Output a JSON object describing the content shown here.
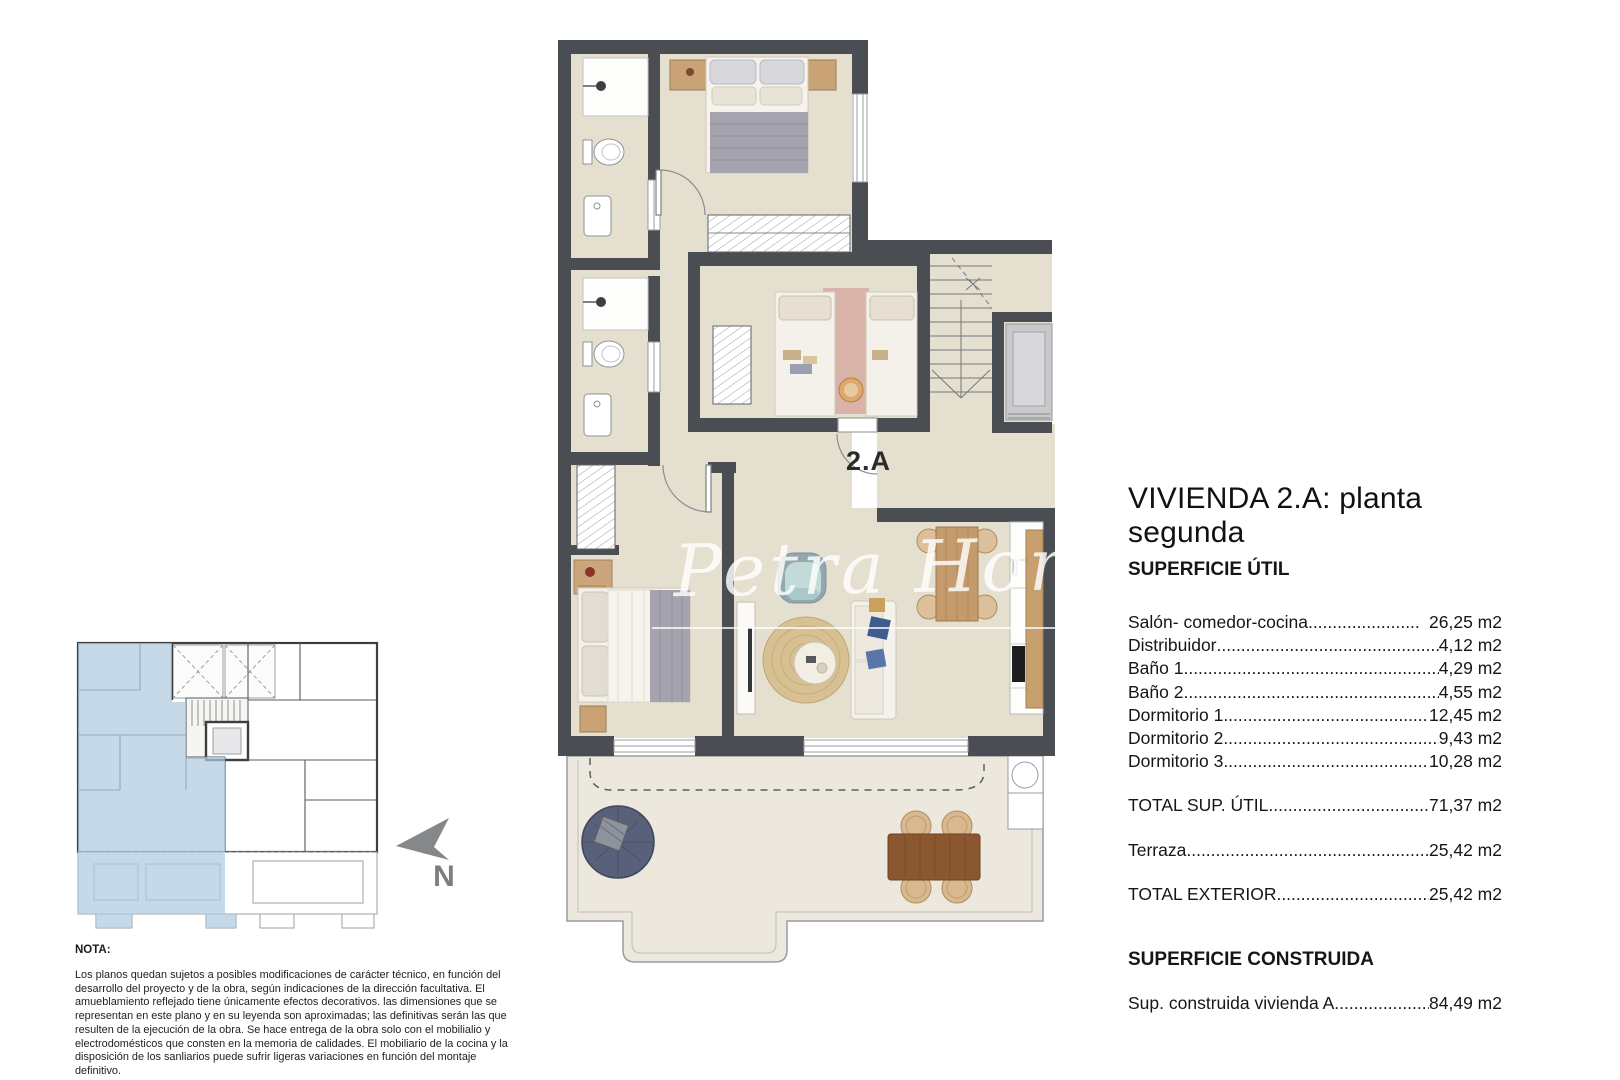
{
  "watermark": {
    "text": "Petra Honig"
  },
  "plan": {
    "unit_label": "2.A",
    "north_label": "N"
  },
  "panel": {
    "title": "VIVIENDA 2.A: planta segunda",
    "superficie_util": {
      "heading": "SUPERFICIE ÚTIL",
      "rows": [
        {
          "label": "Salón- comedor-cocina",
          "value": "26,25 m2",
          "gap": true
        },
        {
          "label": "Distribuidor",
          "value": "4,12 m2"
        },
        {
          "label": "Baño 1",
          "value": "4,29 m2"
        },
        {
          "label": "Baño 2",
          "value": "4,55 m2"
        },
        {
          "label": "Dormitorio 1",
          "value": "12,45 m2"
        },
        {
          "label": "Dormitorio 2",
          "value": "9,43 m2"
        },
        {
          "label": "Dormitorio 3",
          "value": "10,28 m2"
        }
      ],
      "totals": [
        {
          "label": "TOTAL SUP. ÚTIL",
          "value": "71,37 m2"
        },
        {
          "label": "Terraza",
          "value": "25,42 m2"
        },
        {
          "label": "TOTAL EXTERIOR",
          "value": "25,42 m2"
        }
      ]
    },
    "superficie_construida": {
      "heading": "SUPERFICIE CONSTRUIDA",
      "rows": [
        {
          "label": "Sup. construida vivienda A",
          "value": "84,49 m2"
        }
      ]
    }
  },
  "nota": {
    "heading": "NOTA:",
    "body": "Los planos quedan sujetos a posibles modificaciones de carácter técnico, en función del desarrollo del proyecto y de la obra, según indicaciones de la dirección facultativa. El amueblamiento reflejado tiene únicamente efectos decorativos. las dimensiones que se representan en este plano y en su leyenda son aproximadas; las definitivas serán las que resulten de la ejecución de la obra. Se hace entrega de la obra solo con el mobilialio y electrodomésticos que consten en la memoria de calidades. El mobiliario de la cocina y la disposición de los sanliarios puede sufrir ligeras variaciones en función del montaje definitivo."
  },
  "colors": {
    "wall": "#4a4e53",
    "floor": "#e5dfd0",
    "terrace": "#ece8de",
    "highlight_blue": "#aecbe0",
    "wood": "#c49b6c",
    "terrace_table": "#8a5731",
    "lounge": "#59617a"
  }
}
